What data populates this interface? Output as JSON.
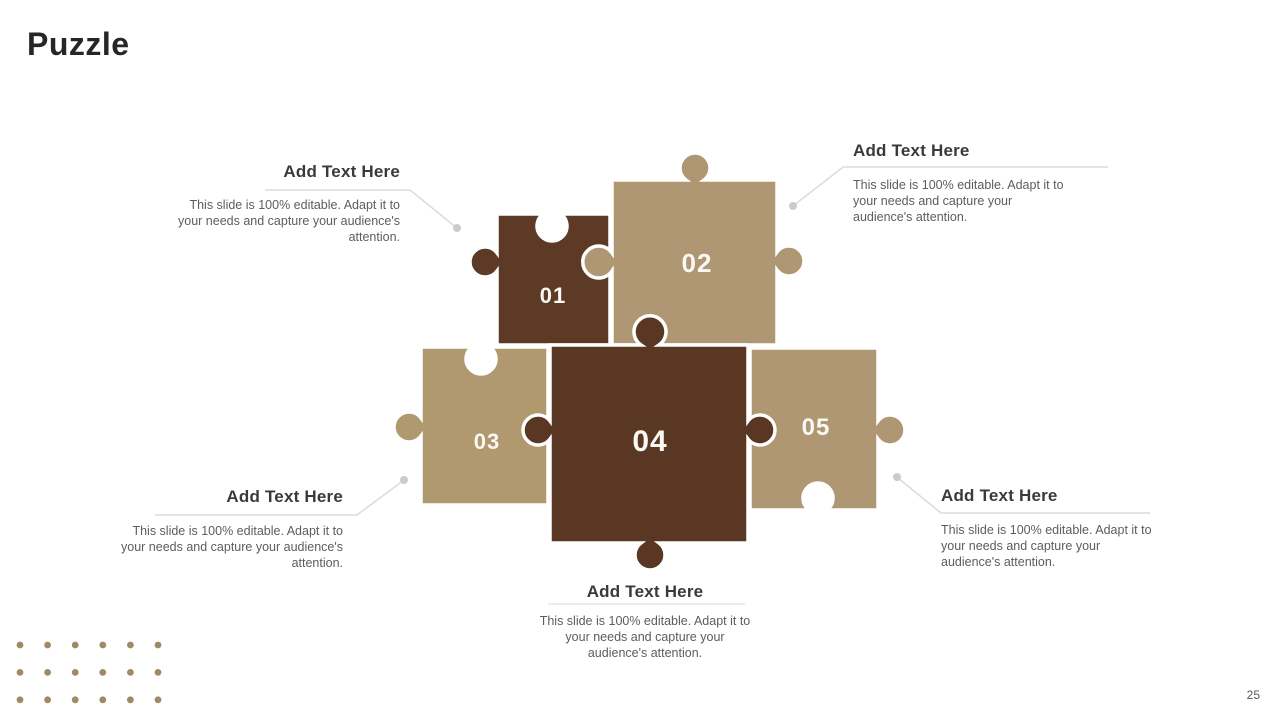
{
  "slide": {
    "title": "Puzzle",
    "page_number": "25"
  },
  "puzzle": {
    "pieces": [
      {
        "number": "01",
        "color": "#5c3a25"
      },
      {
        "number": "02",
        "color": "#ae9772"
      },
      {
        "number": "03",
        "color": "#b0996f"
      },
      {
        "number": "04",
        "color": "#593722"
      },
      {
        "number": "05",
        "color": "#ae9772"
      }
    ],
    "label_color": "#faf8f3"
  },
  "text_blocks": [
    {
      "position": "top-left",
      "heading": "Add Text Here",
      "body": "This slide is 100% editable. Adapt it to your needs and capture your audience's attention."
    },
    {
      "position": "top-right",
      "heading": "Add Text Here",
      "body": "This slide is 100% editable. Adapt it to your needs and capture your audience's attention."
    },
    {
      "position": "bottom-left",
      "heading": "Add Text Here",
      "body": "This slide is 100% editable. Adapt it to your needs and capture your audience's attention."
    },
    {
      "position": "bottom-center",
      "heading": "Add Text Here",
      "body": "This slide is 100% editable. Adapt it to your needs and capture your audience's attention."
    },
    {
      "position": "bottom-right",
      "heading": "Add Text Here",
      "body": "This slide is 100% editable. Adapt it to your needs and capture your audience's attention."
    }
  ],
  "decor": {
    "connector_color": "#dcdcdc",
    "connector_dot_color": "#cbcbcb",
    "dot_grid": {
      "rows": 3,
      "cols": 6,
      "start_x": 20,
      "start_y": 645,
      "dx": 27.6,
      "dy": 27.4,
      "radius": 3.4,
      "color": "#a08a66"
    }
  }
}
